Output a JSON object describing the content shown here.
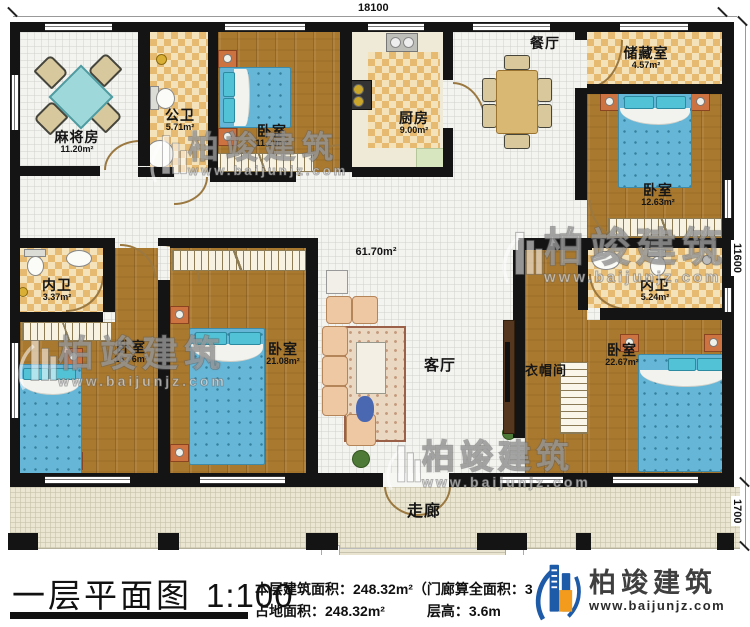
{
  "plan": {
    "dimensions": {
      "top": "18100",
      "right_upper": "11600",
      "right_lower": "1700"
    },
    "area_label": "61.70m²",
    "rooms": {
      "mahjong": {
        "name": "麻将房",
        "area": "11.20m²"
      },
      "public_bath": {
        "name": "公卫",
        "area": "5.71m²"
      },
      "bedroom_top_left": {
        "name": "卧室",
        "area": "11.20m²"
      },
      "kitchen": {
        "name": "厨房",
        "area": "9.00m²"
      },
      "dining": {
        "name": "餐厅"
      },
      "storage": {
        "name": "储藏室",
        "area": "4.57m²"
      },
      "bedroom_top_right": {
        "name": "卧室",
        "area": "12.63m²"
      },
      "bath_left": {
        "name": "内卫",
        "area": "3.37m²"
      },
      "bedroom_left": {
        "name": "卧室",
        "area": "16.76m²"
      },
      "bedroom_center": {
        "name": "卧室",
        "area": "21.08m²"
      },
      "living": {
        "name": "客厅"
      },
      "cloakroom": {
        "name": "衣帽间"
      },
      "bath_right": {
        "name": "内卫",
        "area": "5.24m²"
      },
      "bedroom_bottom_right": {
        "name": "卧室",
        "area": "22.67m²"
      },
      "corridor": {
        "name": "走廊"
      }
    }
  },
  "watermark": {
    "brand": "柏竣建筑",
    "url": "www.baijunjz.com"
  },
  "title_block": {
    "title": "一层平面图",
    "scale": "1:100",
    "info_line1": "本层建筑面积：248.32m²（门廊算全面积：31.1",
    "info_line2a": "占地面积：248.32m²",
    "info_line2b": "层高：3.6m"
  },
  "logo": {
    "brand": "柏竣建筑",
    "url": "www.baijunjz.com"
  },
  "colors": {
    "logo_blue": "#1d5aa8",
    "logo_orange": "#f29b1d",
    "wall": "#141414",
    "wood_floor": "#a9792f",
    "tile_check": "#e6ba70"
  }
}
